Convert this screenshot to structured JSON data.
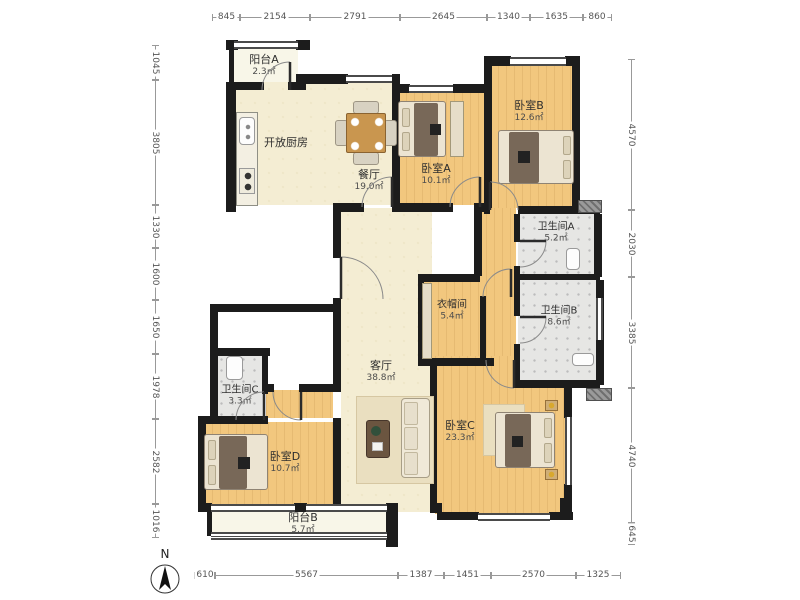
{
  "compass": {
    "label": "N"
  },
  "dimensions": {
    "top": [
      "845",
      "2154",
      "2791",
      "2645",
      "1340",
      "1635",
      "860"
    ],
    "left": [
      "1045",
      "3805",
      "1330",
      "1600",
      "1650",
      "1978",
      "2582",
      "1016"
    ],
    "right": [
      "4570",
      "2030",
      "3385",
      "4740",
      "645"
    ],
    "bottom": [
      "610",
      "5567",
      "1387",
      "1451",
      "2570",
      "1325"
    ]
  },
  "rooms": {
    "balcony_a": {
      "name": "阳台A",
      "area": "2.3㎡"
    },
    "kitchen": {
      "name": "开放厨房"
    },
    "dining": {
      "name": "餐厅",
      "area": "19.0㎡"
    },
    "bedroom_a": {
      "name": "卧室A",
      "area": "10.1㎡"
    },
    "bedroom_b": {
      "name": "卧室B",
      "area": "12.6㎡"
    },
    "bath_a": {
      "name": "卫生间A",
      "area": "5.2㎡"
    },
    "bath_b": {
      "name": "卫生间B",
      "area": "8.6㎡"
    },
    "cloakroom": {
      "name": "衣帽间",
      "area": "5.4㎡"
    },
    "living": {
      "name": "客厅",
      "area": "38.8㎡"
    },
    "bedroom_c": {
      "name": "卧室C",
      "area": "23.3㎡"
    },
    "bath_c": {
      "name": "卫生间C",
      "area": "3.3㎡"
    },
    "bedroom_d": {
      "name": "卧室D",
      "area": "10.7㎡"
    },
    "balcony_b": {
      "name": "阳台B",
      "area": "5.7㎡"
    }
  },
  "colors": {
    "wall": "#1c1c1c",
    "wood_floor": "#f2c77e",
    "cream_floor": "#f4edd3",
    "tile_floor": "#e6e6e4",
    "balcony_floor": "#f8f6e8"
  }
}
